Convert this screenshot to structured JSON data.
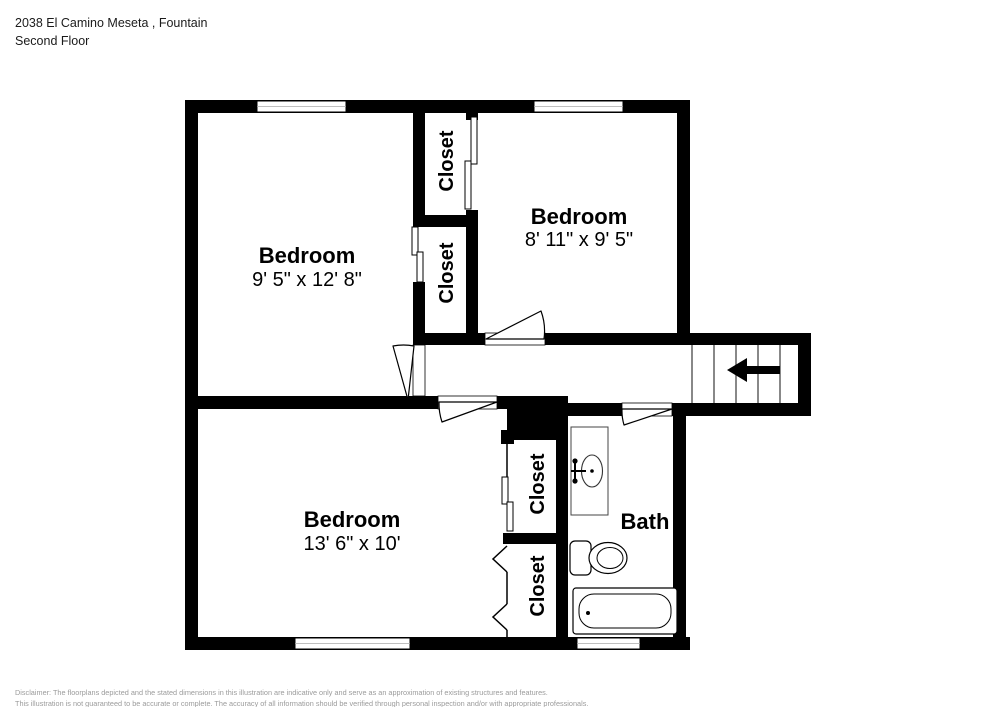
{
  "header": {
    "address": "2038 El Camino Meseta , Fountain",
    "floor": "Second Floor"
  },
  "rooms": [
    {
      "name": "Bedroom",
      "dims": "9' 5\" x 12' 8\""
    },
    {
      "name": "Bedroom",
      "dims": "8' 11\" x 9' 5\""
    },
    {
      "name": "Bedroom",
      "dims": "13' 6\" x 10'"
    },
    {
      "name": "Bath",
      "dims": ""
    }
  ],
  "closets": [
    {
      "label": "Closet"
    },
    {
      "label": "Closet"
    },
    {
      "label": "Closet"
    },
    {
      "label": "Closet"
    }
  ],
  "stairs": {
    "direction_icon": "left-arrow"
  },
  "footer": {
    "line1": "Disclaimer: The floorplans depicted and the stated dimensions in this illustration are indicative only and serve as an approximation of existing structures and features.",
    "line2": "This illustration is not guaranteed to be accurate or complete. The accuracy of all information should be verified through personal inspection and/or with appropriate professionals."
  },
  "colors": {
    "wall": "#000000",
    "fixture": "#2b2b2b",
    "disclaimer": "#9b9b9b"
  }
}
